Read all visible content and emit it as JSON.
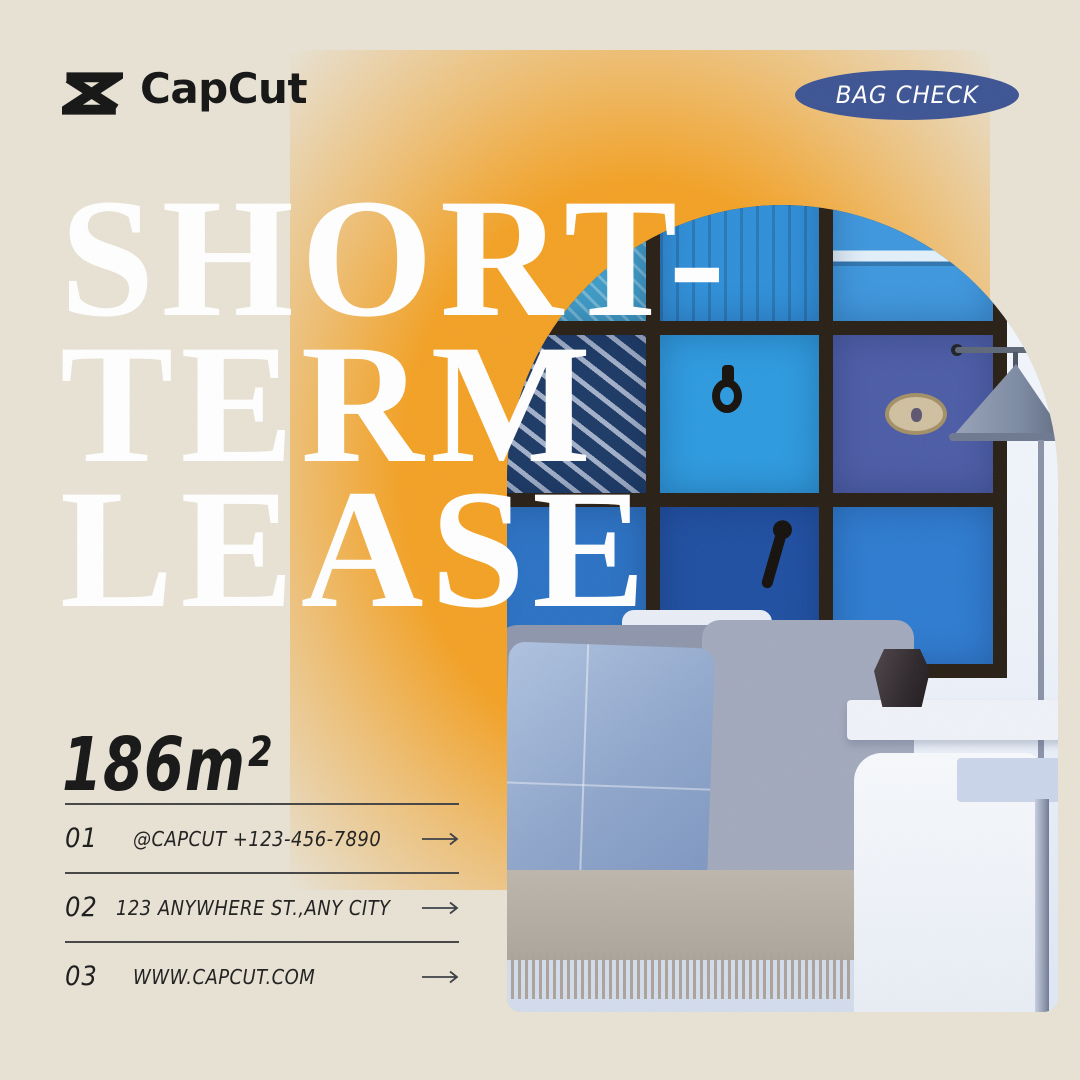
{
  "brand": {
    "logo_text": "CapCut"
  },
  "badge": {
    "label": "BAG CHECK",
    "bg_color": "#3D5494",
    "text_color": "#FFFFFF"
  },
  "headline": {
    "line1": "SHORT-",
    "line2": "TERM",
    "line3": "LEASE",
    "color": "#FFFFFF"
  },
  "area": {
    "value": "186m²"
  },
  "contacts": {
    "rows": [
      {
        "num": "01",
        "label": "@CAPCUT  +123-456-7890"
      },
      {
        "num": "02",
        "label": "123 ANYWHERE ST.,ANY CITY"
      },
      {
        "num": "03",
        "label": "WWW.CAPCUT.COM"
      }
    ]
  },
  "photo": {
    "description": "Living room with gallery wall of blue doors, cone floor lamp, white sofa with blue pillow and fringed throw"
  },
  "colors": {
    "background": "#E8E2D4",
    "accent_orange": "#F3A124",
    "badge_blue": "#3D5494",
    "text": "#1E1E1E",
    "headline": "#FFFFFF"
  }
}
